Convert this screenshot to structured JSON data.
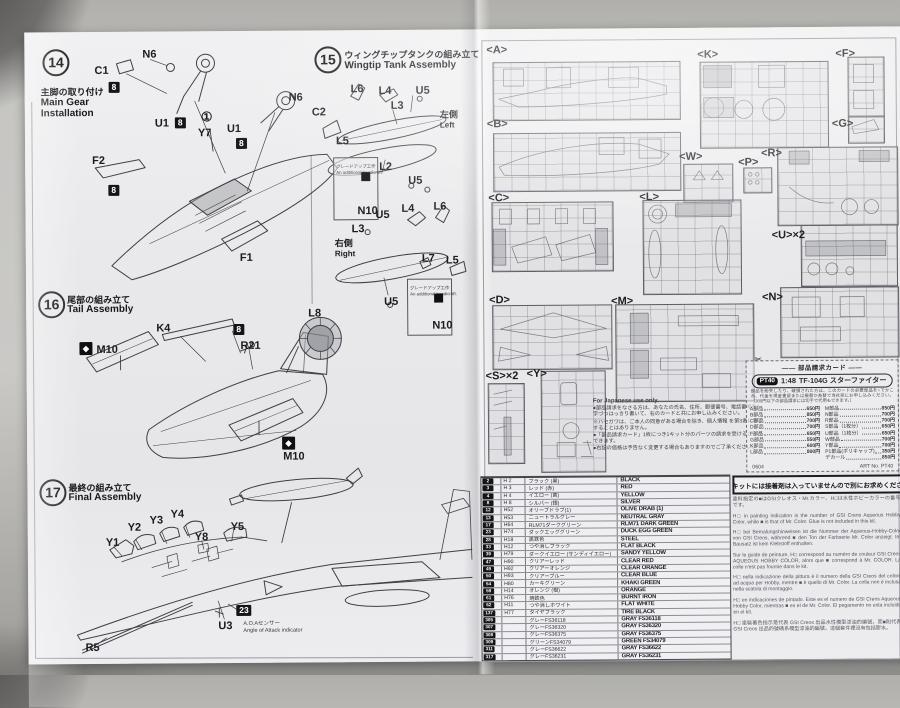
{
  "steps": [
    {
      "num": "14",
      "ja": "主脚の取り付け",
      "en": "Main Gear\nInstallation"
    },
    {
      "num": "15",
      "ja": "ウィングチップタンクの組み立て",
      "en": "Wingtip Tank Assembly"
    },
    {
      "num": "16",
      "ja": "尾部の組み立て",
      "en": "Tail Assembly"
    },
    {
      "num": "17",
      "ja": "最終の組み立て",
      "en": "Final Assembly"
    }
  ],
  "callouts": [
    {
      "t": "C1",
      "x": 96,
      "y": 64
    },
    {
      "t": "8",
      "x": 110,
      "y": 80,
      "k": "box"
    },
    {
      "t": "N6",
      "x": 144,
      "y": 48
    },
    {
      "t": "U1",
      "x": 156,
      "y": 117
    },
    {
      "t": "8",
      "x": 176,
      "y": 116,
      "k": "box"
    },
    {
      "t": "①",
      "x": 202,
      "y": 110,
      "k": "circ"
    },
    {
      "t": "Y7",
      "x": 199,
      "y": 127
    },
    {
      "t": "U1",
      "x": 228,
      "y": 123
    },
    {
      "t": "8",
      "x": 237,
      "y": 137,
      "k": "box"
    },
    {
      "t": "N6",
      "x": 290,
      "y": 92
    },
    {
      "t": "C2",
      "x": 313,
      "y": 107
    },
    {
      "t": "F2",
      "x": 93,
      "y": 154
    },
    {
      "t": "8",
      "x": 109,
      "y": 183,
      "k": "box"
    },
    {
      "t": "F1",
      "x": 240,
      "y": 252
    },
    {
      "t": "L6",
      "x": 352,
      "y": 84
    },
    {
      "t": "L4",
      "x": 380,
      "y": 86
    },
    {
      "t": "U5",
      "x": 417,
      "y": 86
    },
    {
      "t": "L3",
      "x": 392,
      "y": 101
    },
    {
      "t": "左側",
      "x": 441,
      "y": 110,
      "k": "jp"
    },
    {
      "t": "Left",
      "x": 441,
      "y": 120,
      "k": "sub2"
    },
    {
      "t": "L5",
      "x": 337,
      "y": 136
    },
    {
      "t": "L2",
      "x": 380,
      "y": 162
    },
    {
      "t": "U5",
      "x": 409,
      "y": 176
    },
    {
      "t": "グレードアップ工作",
      "x": 337,
      "y": 161,
      "k": "tiny"
    },
    {
      "t": "An additional handicraft.",
      "x": 337,
      "y": 167,
      "k": "tiny"
    },
    {
      "t": "",
      "x": 362,
      "y": 172,
      "k": "mini"
    },
    {
      "t": "N10",
      "x": 358,
      "y": 206
    },
    {
      "t": "U5",
      "x": 376,
      "y": 210
    },
    {
      "t": "L3",
      "x": 352,
      "y": 224
    },
    {
      "t": "右側",
      "x": 335,
      "y": 238,
      "k": "jp"
    },
    {
      "t": "Right",
      "x": 335,
      "y": 248,
      "k": "sub2"
    },
    {
      "t": "L4",
      "x": 402,
      "y": 204
    },
    {
      "t": "L6",
      "x": 434,
      "y": 202
    },
    {
      "t": "L7",
      "x": 422,
      "y": 254
    },
    {
      "t": "L5",
      "x": 446,
      "y": 256
    },
    {
      "t": "U5",
      "x": 384,
      "y": 297
    },
    {
      "t": "グレードアップ工作",
      "x": 410,
      "y": 283,
      "k": "tiny"
    },
    {
      "t": "An additional handicraft.",
      "x": 410,
      "y": 289,
      "k": "tiny"
    },
    {
      "t": "",
      "x": 434,
      "y": 294,
      "k": "mini"
    },
    {
      "t": "N10",
      "x": 432,
      "y": 321
    },
    {
      "t": "K4",
      "x": 156,
      "y": 322
    },
    {
      "t": "8",
      "x": 233,
      "y": 323,
      "k": "box"
    },
    {
      "t": "R21",
      "x": 240,
      "y": 340
    },
    {
      "t": "L8",
      "x": 308,
      "y": 308
    },
    {
      "t": "◆",
      "x": 79,
      "y": 340,
      "k": "mark"
    },
    {
      "t": "M10",
      "x": 96,
      "y": 343
    },
    {
      "t": "◆",
      "x": 281,
      "y": 436,
      "k": "mark"
    },
    {
      "t": "M10",
      "x": 282,
      "y": 451
    },
    {
      "t": "Y4",
      "x": 169,
      "y": 508
    },
    {
      "t": "Y3",
      "x": 148,
      "y": 514
    },
    {
      "t": "Y2",
      "x": 126,
      "y": 521
    },
    {
      "t": "Y1",
      "x": 104,
      "y": 536
    },
    {
      "t": "Y5",
      "x": 229,
      "y": 521
    },
    {
      "t": "Y8",
      "x": 193,
      "y": 531
    },
    {
      "t": "23",
      "x": 234,
      "y": 604,
      "k": "box"
    },
    {
      "t": "U3",
      "x": 216,
      "y": 620
    },
    {
      "t": "A.O.Aセンサー",
      "x": 241,
      "y": 618,
      "k": "sub"
    },
    {
      "t": "Angle of Attack indicator",
      "x": 241,
      "y": 625,
      "k": "sub"
    },
    {
      "t": "R5",
      "x": 83,
      "y": 641
    },
    {
      "t": "<A>",
      "x": 488,
      "y": 46,
      "k": "sp"
    },
    {
      "t": "<B>",
      "x": 488,
      "y": 120,
      "k": "sp"
    },
    {
      "t": "<C>",
      "x": 489,
      "y": 194,
      "k": "sp"
    },
    {
      "t": "<D>",
      "x": 489,
      "y": 296,
      "k": "sp"
    },
    {
      "t": "<K>",
      "x": 699,
      "y": 52,
      "k": "sp"
    },
    {
      "t": "<F>",
      "x": 837,
      "y": 52,
      "k": "sp"
    },
    {
      "t": "<G>",
      "x": 833,
      "y": 122,
      "k": "sp"
    },
    {
      "t": "<W>",
      "x": 680,
      "y": 154,
      "k": "sp"
    },
    {
      "t": "<P>",
      "x": 739,
      "y": 160,
      "k": "sp"
    },
    {
      "t": "<R>",
      "x": 762,
      "y": 151,
      "k": "sp"
    },
    {
      "t": "<L>",
      "x": 640,
      "y": 194,
      "k": "sp"
    },
    {
      "t": "<M>",
      "x": 611,
      "y": 298,
      "k": "sp"
    },
    {
      "t": "<U>×2",
      "x": 772,
      "y": 233,
      "k": "sp"
    },
    {
      "t": "<N>",
      "x": 762,
      "y": 295,
      "k": "sp"
    },
    {
      "t": "<S>×2",
      "x": 485,
      "y": 372,
      "k": "sp"
    },
    {
      "t": "<Y>",
      "x": 526,
      "y": 370,
      "k": "sp"
    }
  ],
  "insets": [
    {
      "x": 334,
      "y": 157,
      "w": 43,
      "h": 61
    },
    {
      "x": 407,
      "y": 279,
      "w": 43,
      "h": 55
    }
  ],
  "sprues": [
    {
      "x": 494,
      "y": 63,
      "w": 186,
      "h": 57
    },
    {
      "x": 494,
      "y": 134,
      "w": 186,
      "h": 57
    },
    {
      "x": 492,
      "y": 203,
      "w": 120,
      "h": 68
    },
    {
      "x": 492,
      "y": 306,
      "w": 118,
      "h": 63
    },
    {
      "x": 701,
      "y": 64,
      "w": 127,
      "h": 85
    },
    {
      "x": 849,
      "y": 60,
      "w": 35,
      "h": 59
    },
    {
      "x": 849,
      "y": 119,
      "w": 35,
      "h": 26
    },
    {
      "x": 684,
      "y": 166,
      "w": 48,
      "h": 37
    },
    {
      "x": 744,
      "y": 170,
      "w": 27,
      "h": 24
    },
    {
      "x": 778,
      "y": 150,
      "w": 119,
      "h": 77
    },
    {
      "x": 643,
      "y": 202,
      "w": 97,
      "h": 93
    },
    {
      "x": 615,
      "y": 306,
      "w": 137,
      "h": 96
    },
    {
      "x": 801,
      "y": 228,
      "w": 95,
      "h": 60
    },
    {
      "x": 780,
      "y": 290,
      "w": 117,
      "h": 69
    },
    {
      "x": 487,
      "y": 384,
      "w": 35,
      "h": 79
    },
    {
      "x": 540,
      "y": 372,
      "w": 63,
      "h": 100
    }
  ],
  "notices": {
    "glue": "このキットには接着剤は入っていませんので別にお求めください。",
    "jp_only": {
      "title": "For Japanese use only.",
      "lines": [
        {
          "t": "●部品請求をなさる方は、あなたの氏名、住所、郵便番号、電話番号を1字づつはっきり書いて、右のカードと共にお申し込みください。"
        },
        {
          "t": "※ハセガワは、ご本人の同意がある場合を除き、個人情報 を第3者に開示することはありません。"
        },
        {
          "t": "●「部品請求カード」1枚につき1キット分のパーツの請求を受けることができます。"
        },
        {
          "t": "●右記の価格は予告なく変更する場合もありますのでご了承ください。"
        }
      ]
    }
  },
  "parts_card": {
    "header": "―― 部品請求カード ――",
    "badge": "PT40",
    "scale": "1:48",
    "kit_name": "TF-104G スターファイター",
    "note": "部品を紛失したり、破損された方は、このカードの必要部品を○でかこみ、代金を現金書留または振替か為替で当社宛にお申し込みください。（300円以下の部品請求には切手で代用もできます。）",
    "left": [
      {
        "n": "A部品",
        "p": "650円"
      },
      {
        "n": "B部品",
        "p": "850円"
      },
      {
        "n": "C部品",
        "p": "700円"
      },
      {
        "n": "D部品",
        "p": "700円"
      },
      {
        "n": "F部品",
        "p": "650円"
      },
      {
        "n": "G部品",
        "p": "550円"
      },
      {
        "n": "K部品",
        "p": "600円"
      },
      {
        "n": "L部品",
        "p": "800円"
      }
    ],
    "right": [
      {
        "n": "M部品",
        "p": "850円"
      },
      {
        "n": "N部品",
        "p": "700円"
      },
      {
        "n": "R部品",
        "p": "700円"
      },
      {
        "n": "S部品（1枚分）",
        "p": "650円"
      },
      {
        "n": "U部品（1枚分）",
        "p": "650円"
      },
      {
        "n": "W部品",
        "p": "700円"
      },
      {
        "n": "Y部品",
        "p": "700円"
      },
      {
        "n": "P1部品(ポリキャップ)",
        "p": "350円"
      },
      {
        "n": "デカール",
        "p": "850円"
      }
    ],
    "code": "0604",
    "artno": "ART No. PT40"
  },
  "paint_notes": [
    {
      "t": "塗料指定の■はGSIクレオス・Mr.カラー、H□は水性ホビーカラーの番号です。"
    },
    {
      "t": "H□ in painting indication is the number of GSI Creos Aqueous Hobby Color, while ■ is that of Mr. Color. Glue is not included in this kit."
    },
    {
      "t": "H□ bei Bemalungshinweisen ist die Nummer der Aqueous-Hobby-Color von GSI Creos, während ■ den Ton der Farbserie Mr. Color anzeigt. Im Bausatz ist kein Klebstoff enthalten."
    },
    {
      "t": "Sur le guide de peinture, H□ correspond au numéro de couleur GSI Creos AQUEOUS HOBBY COLOR, alors que ■ correspond à Mr. COLOR. La colle n'est pas fournie dans le kit."
    },
    {
      "t": "H□ nella indicazione della pittura è il numero della GSI Creos del colore ad acqua per Hobby, mentre ■ è quello di Mr. Color. La colla non è inclusa nella scatola di montaggio."
    },
    {
      "t": "H□ en indicaciones de pintado. Este es el numero de GSI Creos Aqueous Hobby Color, mientras ■ es el de Mr. Color. El pegamento no esta incluido en el kit."
    },
    {
      "t": "H□ 塗裝著色指示是代表 GSI Creos 出品水性模型漆油的編號，而■則代表 GSI Creos 出品的號碼系模型漆油的編號。這個套件裡沒有包括膠水。"
    }
  ],
  "colors": [
    {
      "c": "2",
      "h": "H 2",
      "ja": "ブラック (黒)",
      "en": "BLACK"
    },
    {
      "c": "3",
      "h": "H 3",
      "ja": "レッド (赤)",
      "en": "RED"
    },
    {
      "c": "4",
      "h": "H 4",
      "ja": "イエロー (黄)",
      "en": "YELLOW"
    },
    {
      "c": "8",
      "h": "H 8",
      "ja": "シルバー (銀)",
      "en": "SILVER"
    },
    {
      "c": "12",
      "h": "H52",
      "ja": "オリーブドラブ(1)",
      "en": "OLIVE DRAB (1)"
    },
    {
      "c": "13",
      "h": "H53",
      "ja": "ニュートラルグレー",
      "en": "NEUTRAL GRAY"
    },
    {
      "c": "17",
      "h": "H64",
      "ja": "RLM71ダークグリーン",
      "en": "RLM71 DARK GREEN"
    },
    {
      "c": "23",
      "h": "H74",
      "ja": "ダックエッググリーン",
      "en": "DUCK EGG GREEN"
    },
    {
      "c": "28",
      "h": "H18",
      "ja": "黒鉄色",
      "en": "STEEL"
    },
    {
      "c": "33",
      "h": "H12",
      "ja": "つや消しブラック",
      "en": "FLAT BLACK"
    },
    {
      "c": "39",
      "h": "H79",
      "ja": "ダークイエロー (サンディイエロー)",
      "en": "SANDY YELLOW"
    },
    {
      "c": "47",
      "h": "H90",
      "ja": "クリアーレッド",
      "en": "CLEAR RED"
    },
    {
      "c": "49",
      "h": "H92",
      "ja": "クリアーオレンジ",
      "en": "CLEAR ORANGE"
    },
    {
      "c": "50",
      "h": "H93",
      "ja": "クリアーブルー",
      "en": "CLEAR BLUE"
    },
    {
      "c": "54",
      "h": "H80",
      "ja": "カーキグリーン",
      "en": "KHAKI GREEN"
    },
    {
      "c": "59",
      "h": "H14",
      "ja": "オレンジ (橙)",
      "en": "ORANGE"
    },
    {
      "c": "61",
      "h": "H76",
      "ja": "焼鉄色",
      "en": "BURNT IRON"
    },
    {
      "c": "62",
      "h": "H11",
      "ja": "つや消しホワイト",
      "en": "FLAT WHITE"
    },
    {
      "c": "137",
      "h": "H77",
      "ja": "タイヤブラック",
      "en": "TIRE BLACK"
    },
    {
      "c": "305",
      "h": "",
      "ja": "グレーFS36118",
      "en": "GRAY FS36118"
    },
    {
      "c": "307",
      "h": "",
      "ja": "グレーFS36320",
      "en": "GRAY FS36320"
    },
    {
      "c": "308",
      "h": "",
      "ja": "グレーFS36375",
      "en": "GRAY FS36375"
    },
    {
      "c": "309",
      "h": "",
      "ja": "グリーンFS34079",
      "en": "GREEN FS34079"
    },
    {
      "c": "311",
      "h": "",
      "ja": "グレーFS36622",
      "en": "GRAY FS36622"
    },
    {
      "c": "317",
      "h": "",
      "ja": "グレーFS36231",
      "en": "GRAY FS36231"
    }
  ]
}
